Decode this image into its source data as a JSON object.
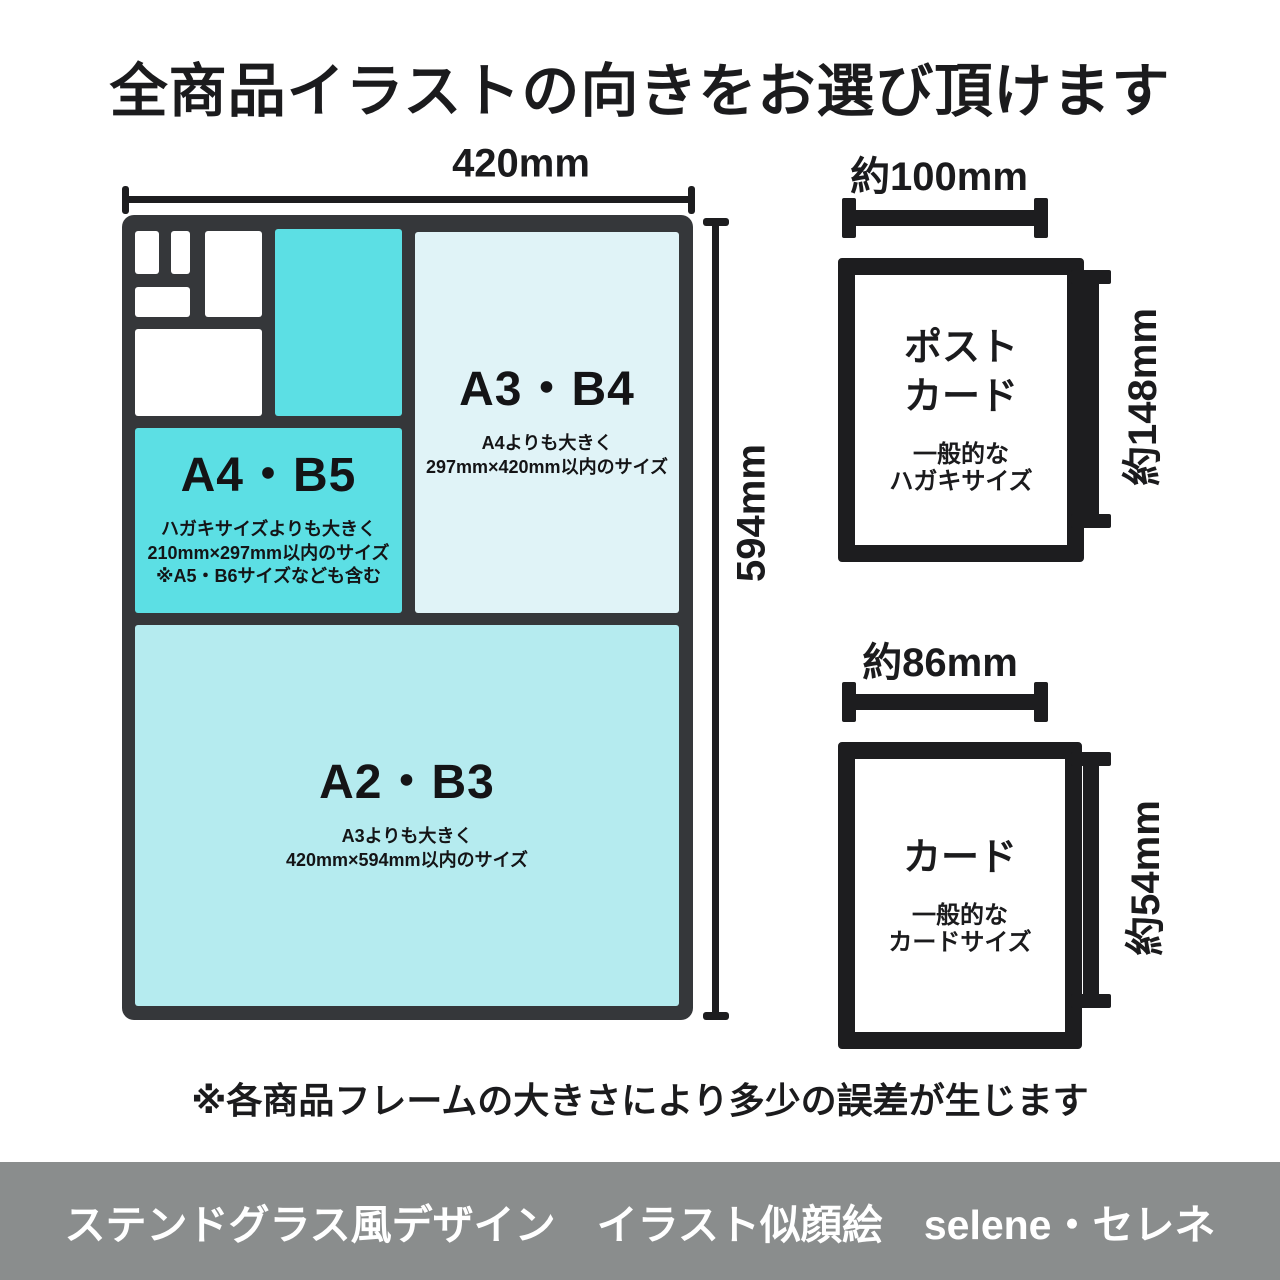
{
  "title": "全商品イラストの向きをお選び頂けます",
  "colors": {
    "frame_dark": "#35373a",
    "teal": "#5cdfe4",
    "light_cyan": "#b5ebef",
    "pale_blue": "#e0f3f7",
    "footer_bg": "#8a8d8d",
    "text": "#1b1b1d"
  },
  "diagram": {
    "width_label": "420mm",
    "height_label": "594mm",
    "sections": {
      "a3b4": {
        "label": "A3・B4",
        "desc1": "A4よりも大きく",
        "desc2": "297mm×420mm以内のサイズ"
      },
      "a4b5": {
        "label": "A4・B5",
        "desc1": "ハガキサイズよりも大きく",
        "desc2": "210mm×297mm以内のサイズ",
        "desc3": "※A5・B6サイズなども含む"
      },
      "a2b3": {
        "label": "A2・B3",
        "desc1": "A3よりも大きく",
        "desc2": "420mm×594mm以内のサイズ"
      }
    }
  },
  "postcard": {
    "width_label": "約100mm",
    "height_label": "約148mm",
    "name_line1": "ポスト",
    "name_line2": "カード",
    "desc1": "一般的な",
    "desc2": "ハガキサイズ"
  },
  "card": {
    "width_label": "約86mm",
    "height_label": "約54mm",
    "name": "カード",
    "desc1": "一般的な",
    "desc2": "カードサイズ"
  },
  "note": "※各商品フレームの大きさにより多少の誤差が生じます",
  "footer": "ステンドグラス風デザイン　イラスト似顔絵　selene・セレネ"
}
